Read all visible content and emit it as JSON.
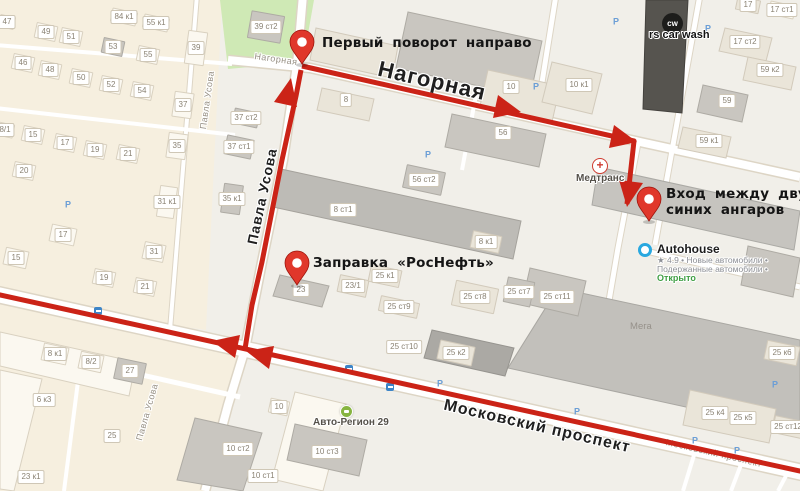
{
  "colors": {
    "route": "#cb2317",
    "pin": "#e0372b",
    "pin_stroke": "#9e150c",
    "land": "#f1efe9",
    "residential": "#f6efdf",
    "green": "#cfe9b5",
    "road": "#ffffff",
    "road_casing": "#ddd5c5",
    "building_light": "#eae5d9",
    "building_medium": "#c9c6c0",
    "building_dark": "#56544f",
    "badge_text": "#8a8273",
    "street_label": "#1f1f1f",
    "open_green": "#3f9e43",
    "autohouse_blue": "#29a8e0"
  },
  "map": {
    "annotations": [
      {
        "id": "first-turn-note",
        "x": 322,
        "y": 35,
        "lines": [
          "Первый поворот направо"
        ]
      },
      {
        "id": "entrance-note",
        "x": 666,
        "y": 186,
        "lines": [
          "Вход между двух",
          "синих ангаров"
        ]
      },
      {
        "id": "gas-station-note",
        "x": 313,
        "y": 255,
        "lines": [
          "Заправка «РосНефть»"
        ]
      }
    ],
    "street_labels": [
      {
        "text": "Нагорная",
        "x": 276,
        "y": 59,
        "rot": 8,
        "size": 9,
        "type": "minor"
      },
      {
        "text": "Нагорная",
        "x": 432,
        "y": 81,
        "rot": 13,
        "size": 22,
        "type": "major"
      },
      {
        "text": "Павла Усова",
        "x": 262,
        "y": 196,
        "rot": -78,
        "size": 14,
        "type": "major"
      },
      {
        "text": "Павла Усова",
        "x": 207,
        "y": 100,
        "rot": -82,
        "size": 9,
        "type": "minor"
      },
      {
        "text": "Павла Усова",
        "x": 147,
        "y": 412,
        "rot": -74,
        "size": 9,
        "type": "minor"
      },
      {
        "text": "Московский проспект",
        "x": 537,
        "y": 427,
        "rot": 13,
        "size": 16,
        "type": "major"
      },
      {
        "text": "Московский проспект",
        "x": 714,
        "y": 453,
        "rot": 13,
        "size": 9,
        "type": "minor"
      }
    ],
    "pois": {
      "carwash": {
        "icon_text": "cw",
        "label": "rs car wash"
      },
      "medtrans": {
        "icon_text": "+",
        "label": "Медтранс"
      },
      "autohouse": {
        "name": "Autohouse",
        "sub1": "★ 4.9 • Новые автомобили •",
        "sub2": "Подержанные автомобили •",
        "status": "Открыто"
      },
      "avtoregion": {
        "label": "Авто-Регион 29"
      },
      "mega": {
        "label": "Мега"
      }
    },
    "badges": [
      [
        "47",
        7,
        22,
        "w",
        16,
        13
      ],
      [
        "49",
        46,
        32,
        "w"
      ],
      [
        "51",
        71,
        37,
        "w"
      ],
      [
        "53",
        113,
        47,
        "m"
      ],
      [
        "55",
        148,
        55,
        "w"
      ],
      [
        "84 к1",
        124,
        17,
        "w",
        26,
        14
      ],
      [
        "55 к1",
        156,
        23,
        "w",
        26,
        14
      ],
      [
        "39",
        196,
        48,
        "w",
        20,
        34,
        8
      ],
      [
        "39 ст2",
        266,
        27,
        "m",
        34,
        28,
        10
      ],
      [
        "46",
        23,
        63,
        "w"
      ],
      [
        "48",
        50,
        70,
        "w"
      ],
      [
        "50",
        81,
        78,
        "w"
      ],
      [
        "52",
        111,
        85,
        "w"
      ],
      [
        "54",
        142,
        91,
        "w"
      ],
      [
        "8/1",
        5,
        130,
        "w",
        18,
        14
      ],
      [
        "15",
        33,
        135,
        "w"
      ],
      [
        "17",
        65,
        143,
        "w"
      ],
      [
        "19",
        95,
        150,
        "w"
      ],
      [
        "21",
        128,
        154,
        "w"
      ],
      [
        "37",
        183,
        105,
        "w",
        20,
        26,
        8
      ],
      [
        "35",
        177,
        146,
        "w",
        20,
        26,
        8
      ],
      [
        "37 ст2",
        246,
        118,
        "m",
        26,
        16
      ],
      [
        "37 ст1",
        239,
        147,
        "m",
        28,
        20
      ],
      [
        "20",
        24,
        171,
        "w"
      ],
      [
        "31 к1",
        167,
        202,
        "w",
        18,
        32,
        8
      ],
      [
        "35 к1",
        232,
        199,
        "m",
        20,
        30,
        8
      ],
      [
        "17",
        63,
        235,
        "w",
        26,
        18
      ],
      [
        "15",
        16,
        258,
        "w",
        24,
        18
      ],
      [
        "31",
        154,
        252,
        "w",
        22,
        18
      ],
      [
        "19",
        104,
        278,
        "w"
      ],
      [
        "21",
        145,
        287,
        "w"
      ],
      [
        "8",
        346,
        100,
        "n"
      ],
      [
        "10",
        511,
        87,
        "n"
      ],
      [
        "56",
        503,
        133,
        "n"
      ],
      [
        "56 ст2",
        424,
        180,
        "m",
        40,
        24
      ],
      [
        "8 ст1",
        343,
        210,
        "n"
      ],
      [
        "8 к1",
        486,
        242,
        "l",
        30,
        18
      ],
      [
        "23",
        301,
        290,
        "n"
      ],
      [
        "23/1",
        353,
        286,
        "l",
        30,
        18
      ],
      [
        "25 к1",
        385,
        276,
        "l",
        32,
        18
      ],
      [
        "25 ст8",
        475,
        297,
        "l",
        44,
        26
      ],
      [
        "25 ст9",
        399,
        307,
        "l",
        40,
        16
      ],
      [
        "25 ст7",
        519,
        292,
        "m",
        28,
        26
      ],
      [
        "25 ст11",
        557,
        297,
        "n"
      ],
      [
        "25 ст10",
        404,
        347,
        "n"
      ],
      [
        "25 к2",
        456,
        353,
        "l",
        36,
        20
      ],
      [
        "17",
        748,
        5,
        "l",
        24,
        14
      ],
      [
        "17 ст1",
        782,
        10,
        "w",
        26,
        14
      ],
      [
        "17 ст2",
        745,
        42,
        "n"
      ],
      [
        "59 к2",
        770,
        70,
        "n"
      ],
      [
        "59",
        727,
        101,
        "n"
      ],
      [
        "59 к1",
        709,
        141,
        "n"
      ],
      [
        "10 к1",
        579,
        85,
        "n"
      ],
      [
        "8 к1",
        55,
        354,
        "w",
        26,
        18
      ],
      [
        "8/2",
        91,
        362,
        "w",
        24,
        18
      ],
      [
        "27",
        130,
        371,
        "m",
        30,
        22
      ],
      [
        "6 к3",
        44,
        400,
        "n"
      ],
      [
        "25",
        112,
        436,
        "n"
      ],
      [
        "23 к1",
        31,
        477,
        "n"
      ],
      [
        "10",
        279,
        407,
        "w",
        20,
        15
      ],
      [
        "10 ст2",
        238,
        449,
        "n"
      ],
      [
        "10 ст3",
        327,
        452,
        "n"
      ],
      [
        "10 ст1",
        263,
        476,
        "n"
      ],
      [
        "25 к4",
        715,
        413,
        "n"
      ],
      [
        "25 к5",
        743,
        418,
        "n"
      ],
      [
        "25 ст12",
        788,
        427,
        "l",
        30,
        18
      ],
      [
        "25 к6",
        782,
        353,
        "l",
        34,
        20
      ]
    ],
    "parking_label": "P",
    "parkings": [
      [
        68,
        205
      ],
      [
        428,
        155
      ],
      [
        616,
        22
      ],
      [
        708,
        29
      ],
      [
        536,
        87
      ],
      [
        440,
        384
      ],
      [
        577,
        412
      ],
      [
        695,
        441
      ],
      [
        737,
        451
      ],
      [
        775,
        385
      ]
    ],
    "transit_stops": [
      [
        98,
        311
      ],
      [
        349,
        369
      ],
      [
        390,
        387
      ]
    ]
  }
}
